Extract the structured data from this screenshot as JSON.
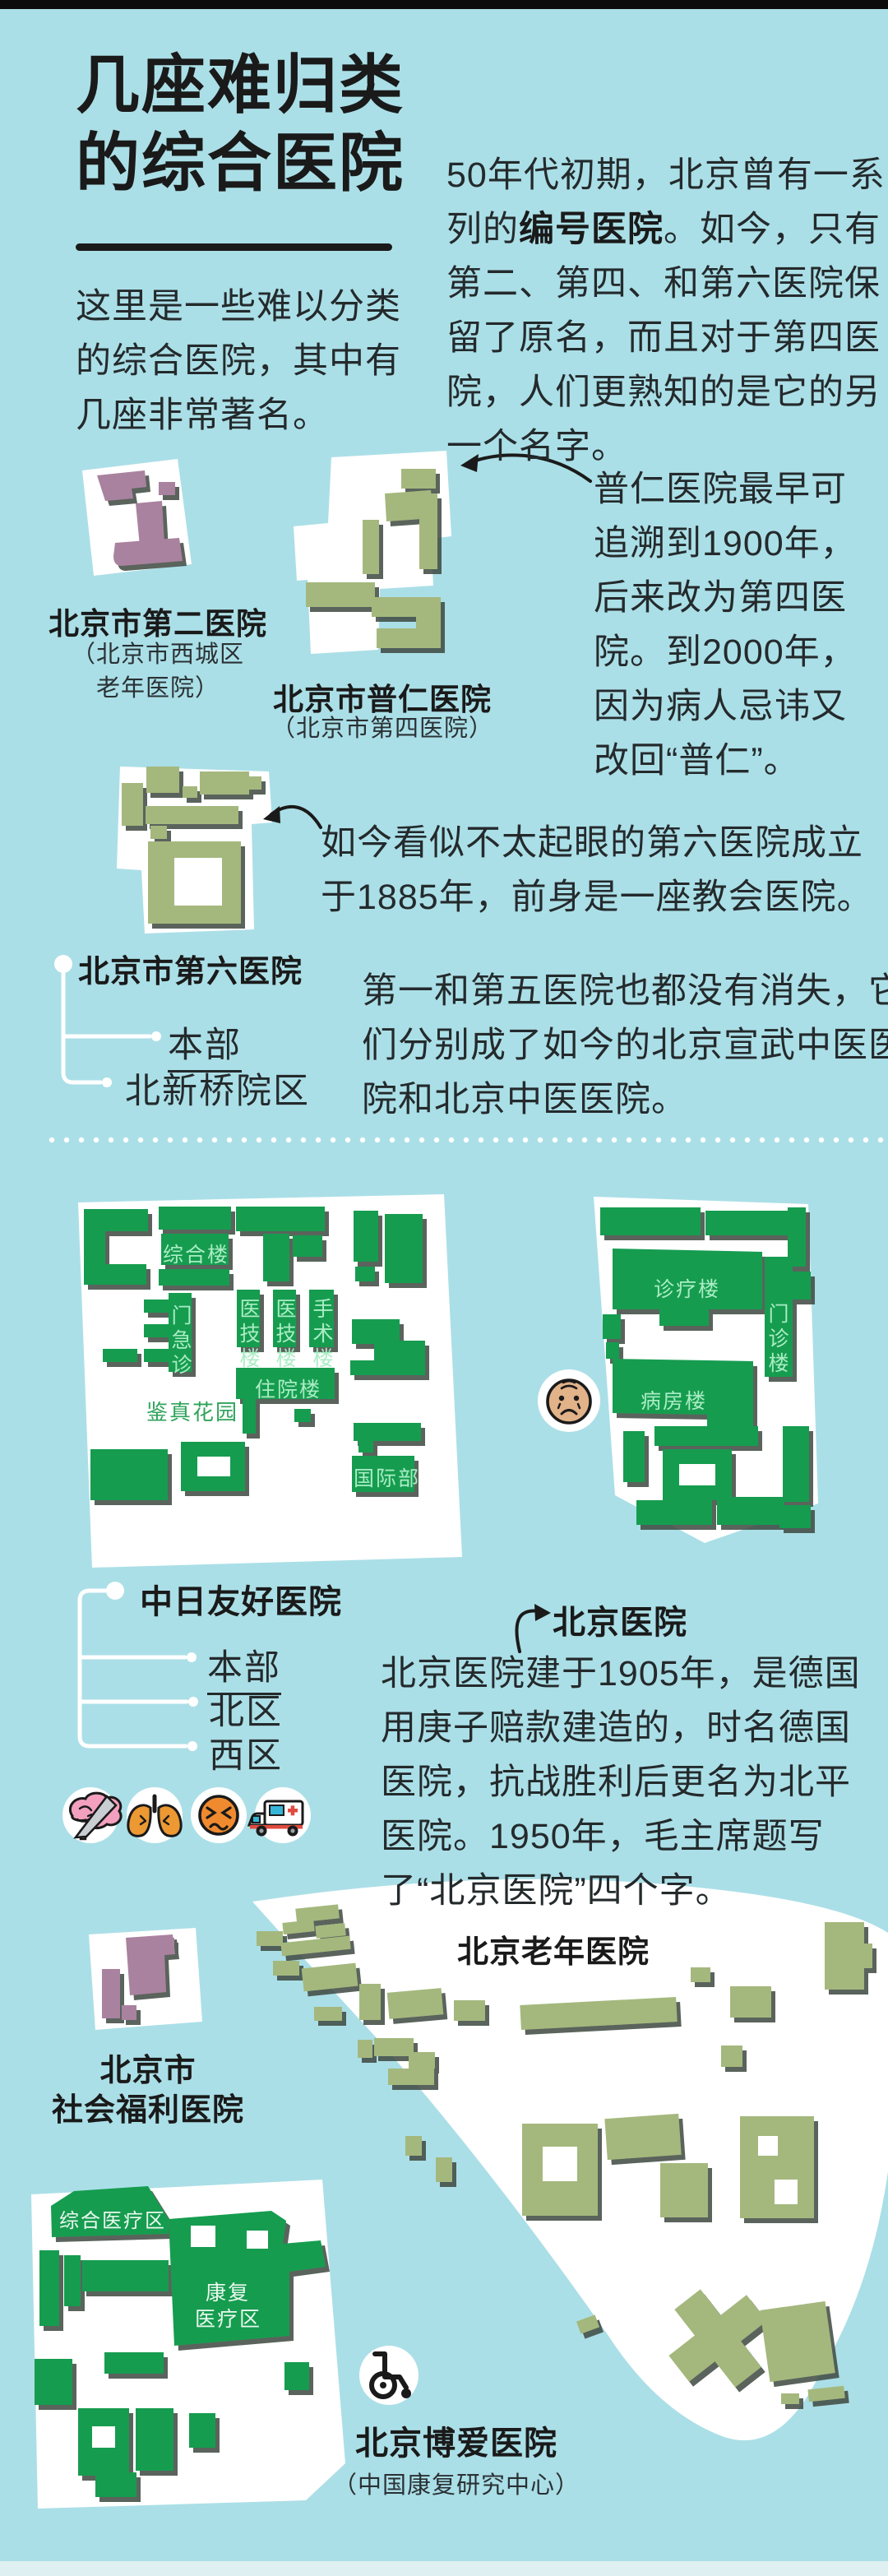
{
  "colors": {
    "bg": "#ABDFE7",
    "ink": "#1A1A1A",
    "body": "#242A2C",
    "green": "#129C50",
    "mint": "#A9EDC4",
    "gtext": "#2FA35B",
    "sage": "#A4B87D",
    "purple": "#A9829F",
    "pale": "#DFF0F2"
  },
  "header": {
    "title_line1": "几座难归类",
    "title_line2": "的综合医院",
    "intro": "这里是一些难以分类的综合医院，其中有几座非常著名。"
  },
  "intro_paragraph": {
    "pre": "50年代初期，北京曾有一系列的",
    "bold": "编号医院",
    "post": "。如今，只有第二、第四、和第六医院保留了原名，而且对于第四医院，人们更熟知的是它的另一个名字。"
  },
  "hospital2": {
    "name": "北京市第二医院",
    "alias_line1": "（北京市西城区",
    "alias_line2": "老年医院）"
  },
  "puren": {
    "name": "北京市普仁医院",
    "alias": "（北京市第四医院）",
    "note": "普仁医院最早可追溯到1900年，后来改为第四医院。到2000年，因为病人忌讳又改回“普仁”。"
  },
  "no6": {
    "name": "北京市第六医院",
    "branches": [
      "本部",
      "北新桥院区"
    ],
    "note": "如今看似不太起眼的第六医院成立于1885年，前身是一座教会医院。",
    "note2": "第一和第五医院也都没有消失，它们分别成了如今的北京宣武中医医院和北京中医医院。"
  },
  "zhongri": {
    "name": "中日友好医院",
    "branches": [
      "本部",
      "北区",
      "西区"
    ],
    "buildings": [
      "综合楼",
      "门急诊",
      "医技楼",
      "医技楼",
      "手术楼",
      "住院楼",
      "国际部"
    ],
    "garden": "鉴真花园"
  },
  "beijing": {
    "name": "北京医院",
    "buildings": [
      "诊疗楼",
      "门诊楼",
      "病房楼"
    ],
    "note": "北京医院建于1905年，是德国用庚子赔款建造的，时名德国医院，抗战胜利后更名为北平医院。1950年，毛主席题写了“北京医院”四个字。"
  },
  "laonian": {
    "name": "北京老年医院"
  },
  "fuli": {
    "name_line1": "北京市",
    "name_line2": "社会福利医院"
  },
  "boai": {
    "name": "北京博爱医院",
    "alias": "（中国康复研究中心）",
    "zone1": "综合医疗区",
    "zone2_line1": "康复",
    "zone2_line2": "医疗区"
  },
  "icons": {
    "neurosurgery": "brain-scalpel-icon",
    "respiratory": "lungs-icon",
    "pain": "sick-face-icon",
    "emergency": "ambulance-icon",
    "elderly": "elder-face-icon",
    "rehab": "wheelchair-icon"
  }
}
